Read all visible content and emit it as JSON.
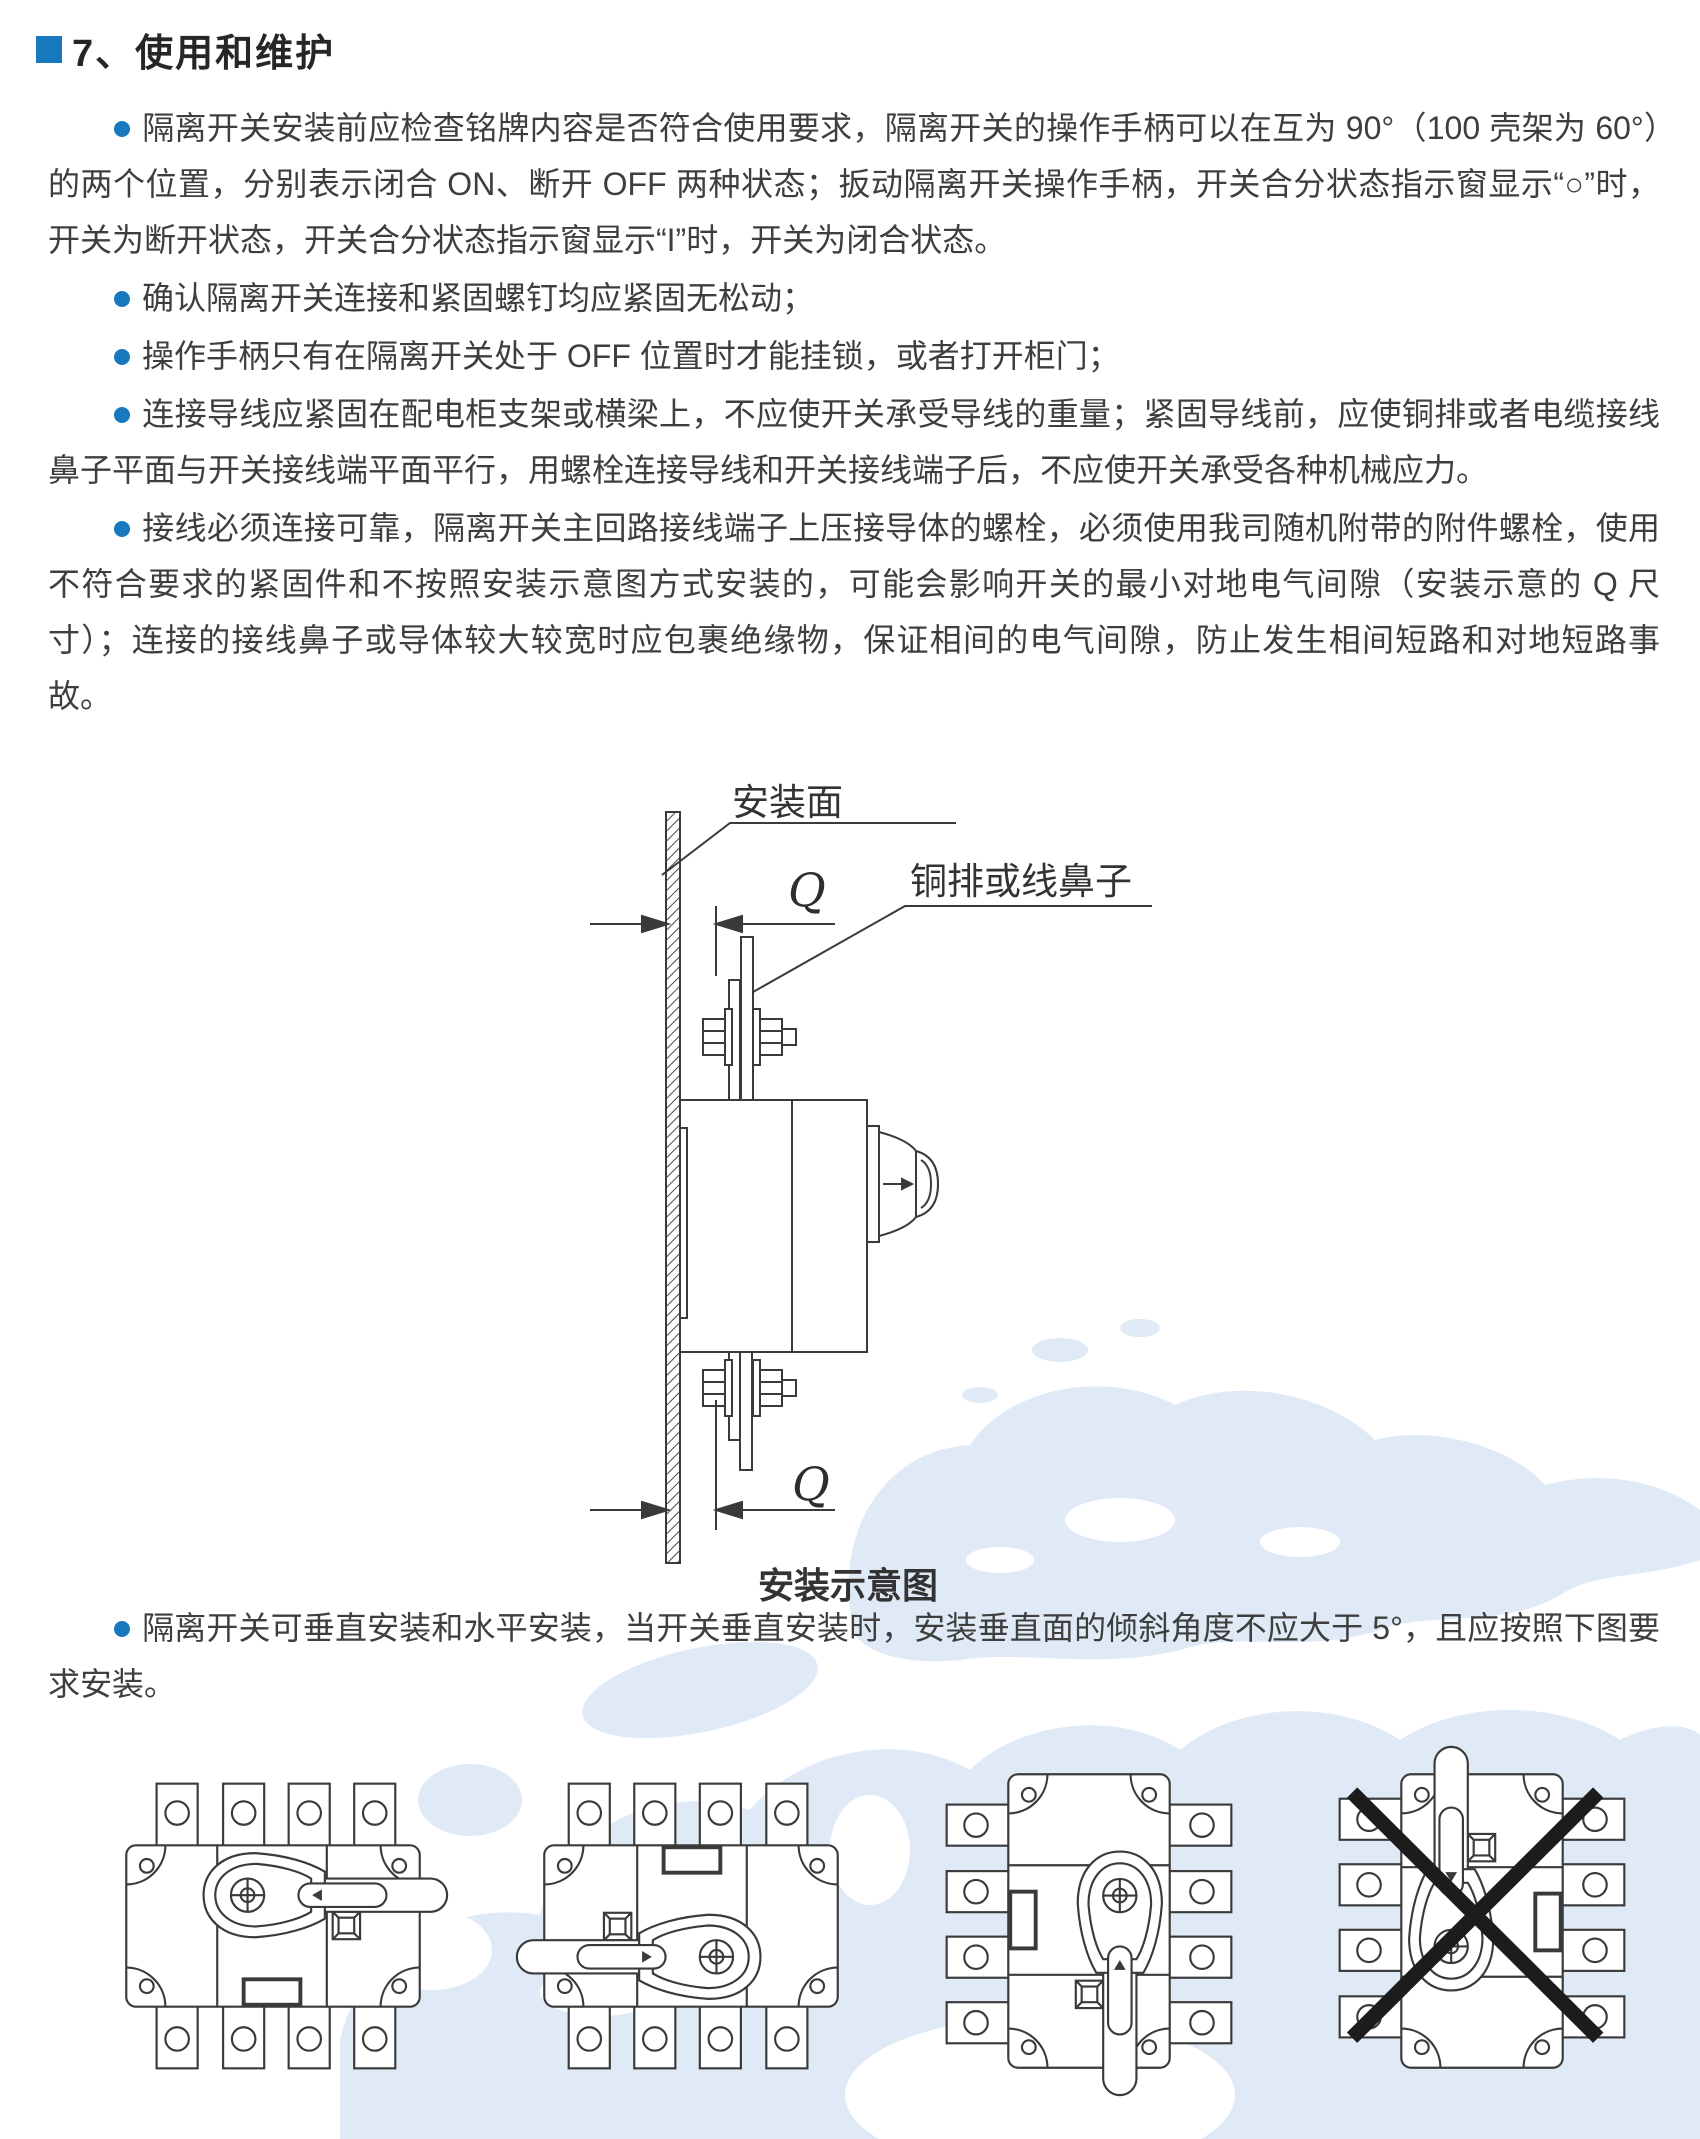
{
  "colors": {
    "accent_blue": "#1878be",
    "body_text": "#3e3e3e",
    "title_text": "#262626",
    "drawing_line": "#3a3a3a",
    "watermark_blue": "#dfeaf6",
    "cross_black": "#1c1c1c"
  },
  "section": {
    "title": "7、使用和维护"
  },
  "paragraphs": [
    {
      "text": "隔离开关安装前应检查铭牌内容是否符合使用要求，隔离开关的操作手柄可以在互为 90°（100 壳架为 60°）的两个位置，分别表示闭合 ON、断开 OFF 两种状态；扳动隔离开关操作手柄，开关合分状态指示窗显示“○”时，开关为断开状态，开关合分状态指示窗显示“I”时，开关为闭合状态。"
    },
    {
      "text": "确认隔离开关连接和紧固螺钉均应紧固无松动；"
    },
    {
      "text": "操作手柄只有在隔离开关处于 OFF 位置时才能挂锁，或者打开柜门；"
    },
    {
      "text": "连接导线应紧固在配电柜支架或横梁上，不应使开关承受导线的重量；紧固导线前，应使铜排或者电缆接线鼻子平面与开关接线端平面平行，用螺栓连接导线和开关接线端子后，不应使开关承受各种机械应力。"
    },
    {
      "text": "接线必须连接可靠，隔离开关主回路接线端子上压接导体的螺栓，必须使用我司随机附带的附件螺栓，使用不符合要求的紧固件和不按照安装示意图方式安装的，可能会影响开关的最小对地电气间隙（安装示意的 Q 尺寸）；连接的接线鼻子或导体较大较宽时应包裹绝缘物，保证相间的电气间隙，防止发生相间短路和对地短路事故。"
    },
    {
      "text": "隔离开关可垂直安装和水平安装，当开关垂直安装时，安装垂直面的倾斜角度不应大于 5°，且应按照下图要求安装。"
    }
  ],
  "figure": {
    "labels": {
      "mounting_surface": "安装面",
      "busbar_or_lug": "铜排或线鼻子",
      "q_top": "Q",
      "q_bottom": "Q"
    },
    "caption": "安装示意图"
  },
  "orientation_figures": [
    {
      "name": "horizontal-handle-right",
      "crossed_out": false
    },
    {
      "name": "horizontal-handle-left",
      "crossed_out": false
    },
    {
      "name": "vertical-handle-down",
      "crossed_out": false
    },
    {
      "name": "vertical-handle-up",
      "crossed_out": true
    }
  ]
}
